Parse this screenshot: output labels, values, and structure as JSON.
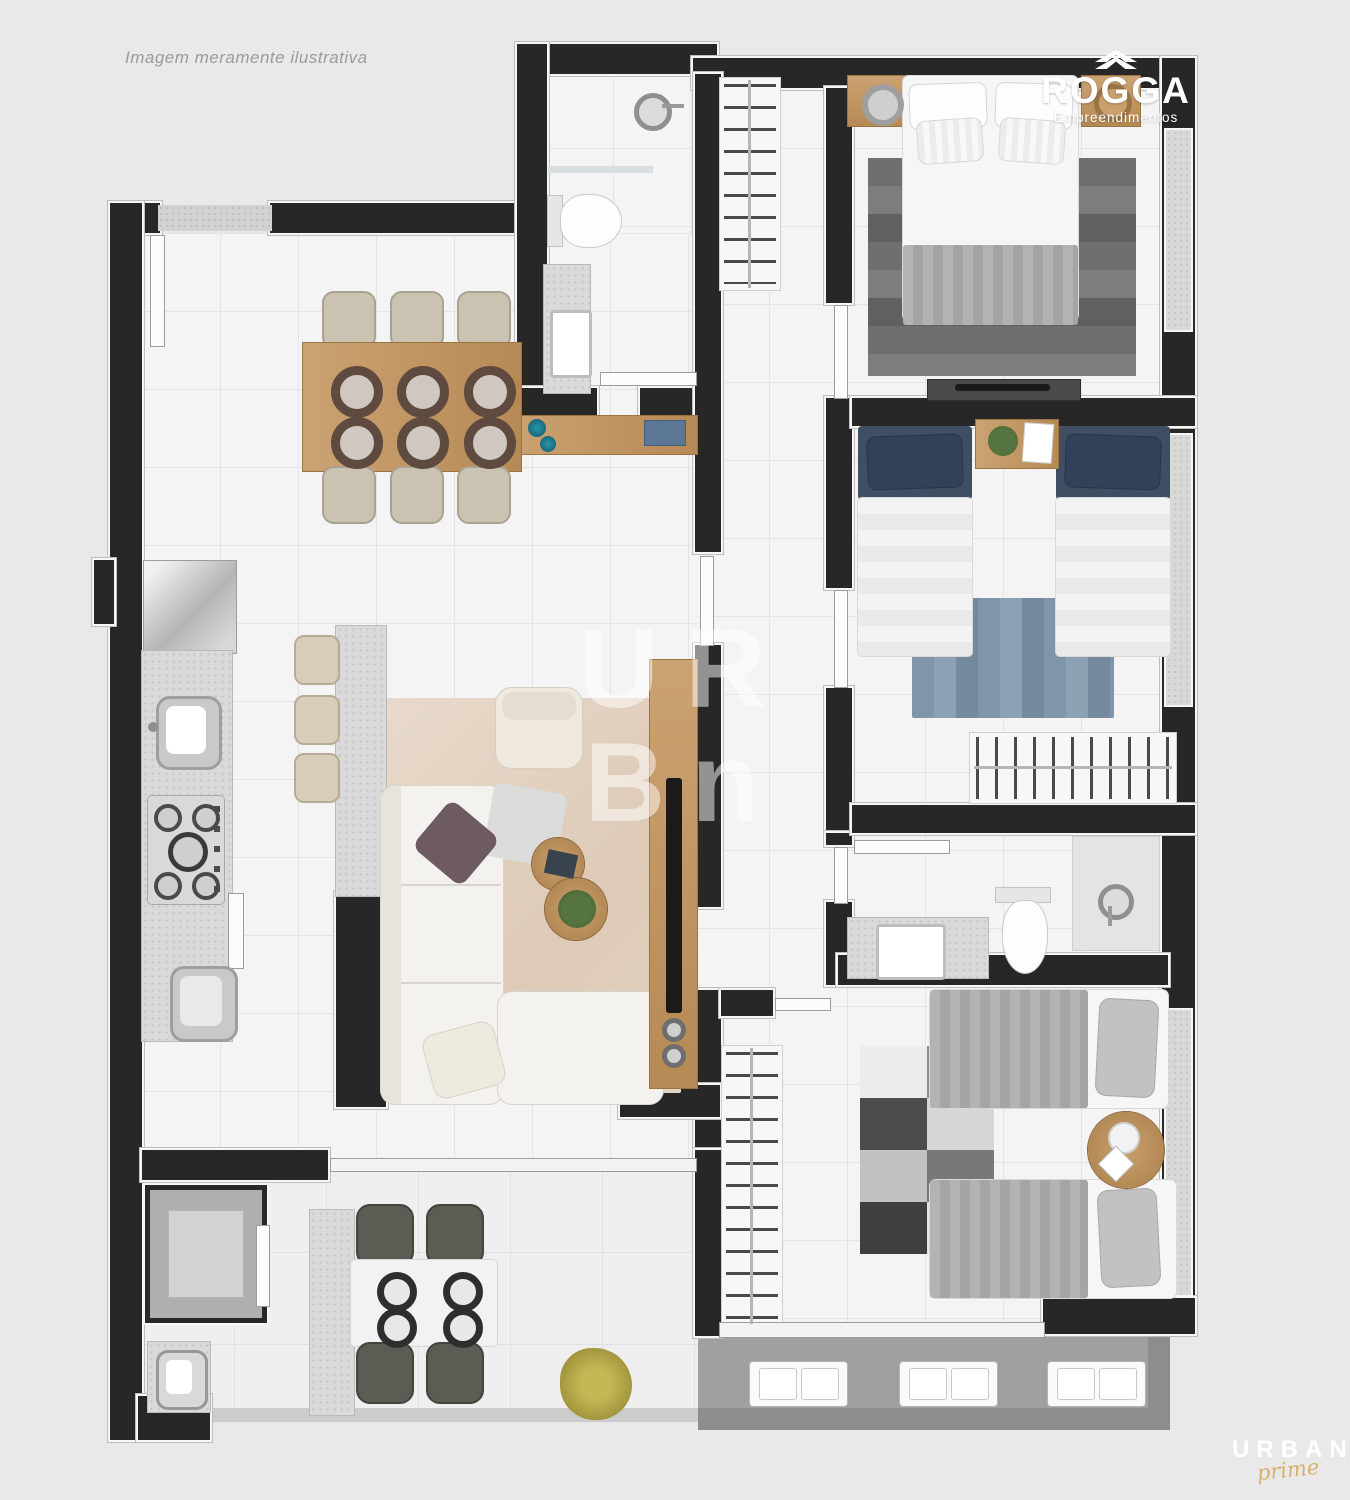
{
  "page": {
    "background_color": "#e9e9e9"
  },
  "disclaimer": "Imagem meramente ilustrativa",
  "branding": {
    "rogga": {
      "name": "ROGGA",
      "tagline": "Empreendimentos",
      "icon": "double-chevron-up-icon",
      "text_color": "#ffffff"
    },
    "urban": {
      "name": "URBAN",
      "script": "prime",
      "name_color": "#ffffff",
      "script_color": "#d8b069"
    }
  },
  "watermark": {
    "line1": "UR",
    "line2": "Bn",
    "color": "rgba(255,255,255,0.5)"
  },
  "palette": {
    "walls": "#272727",
    "wall_outline": "#f6f6f6",
    "floor_tile": "#f4f4f4",
    "tile_line": "#e4e4e4",
    "granite": "#dadada",
    "wood": "#c09564",
    "navy_pillow": "#3e4f63",
    "blue_rug": "#8095a9",
    "beige_rug": "#e6d8ca",
    "balcony_floor": "#a0a0a0",
    "teal_vase": "#1a7488",
    "plant_green": "#55743f",
    "olive_plant": "#b0a346"
  },
  "visible_counts": {
    "dining_chairs": 6,
    "dining_place_settings": 6,
    "terrace_chairs": 4,
    "terrace_place_settings": 4,
    "bar_stools": 3,
    "ac_units": 3,
    "single_beds_blue_room": 2,
    "single_beds_gray_room": 2,
    "double_beds": 1
  }
}
